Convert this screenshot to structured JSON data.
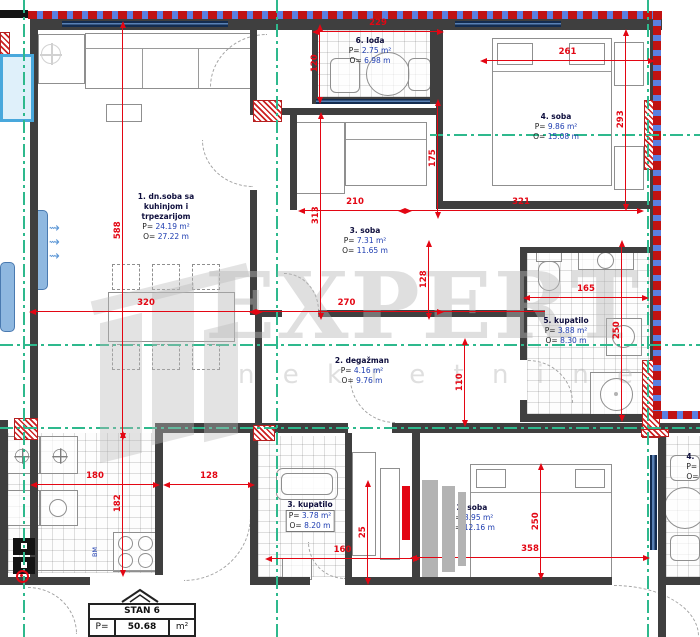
{
  "watermark": {
    "brand": "EXPERT",
    "sub": "n e k r e t n i n e"
  },
  "stamp": {
    "title": "STAN 6",
    "p_label": "P=",
    "p_value": "50.68",
    "p_unit": "m²"
  },
  "labels": {
    "appliance": "BM"
  },
  "rooms": [
    {
      "name": "6. lođa",
      "p_label": "P=",
      "p_value": "2.75",
      "p_unit": "m²",
      "o_label": "O=",
      "o_value": "6.98",
      "o_unit": "m"
    },
    {
      "name": "4. soba",
      "p_label": "P=",
      "p_value": "9.86",
      "p_unit": "m²",
      "o_label": "O=",
      "o_value": "15.08",
      "o_unit": "m"
    },
    {
      "name_line1": "1. dn.soba sa",
      "name_line2": "kuhinjom i",
      "name_line3": "trpezarijom",
      "p_label": "P=",
      "p_value": "24.19",
      "p_unit": "m²",
      "o_label": "O=",
      "o_value": "27.22",
      "o_unit": "m"
    },
    {
      "name": "3. soba",
      "p_label": "P=",
      "p_value": "7.31",
      "p_unit": "m²",
      "o_label": "O=",
      "o_value": "11.65",
      "o_unit": "m"
    },
    {
      "name": "5. kupatilo",
      "p_label": "P=",
      "p_value": "3.88",
      "p_unit": "m²",
      "o_label": "O=",
      "o_value": "8.30",
      "o_unit": "m"
    },
    {
      "name": "2. degažman",
      "p_label": "P=",
      "p_value": "4.16",
      "p_unit": "m²",
      "o_label": "O=",
      "o_value": "9.76",
      "o_unit": "m"
    },
    {
      "name": "3. kupatilo",
      "p_label": "P=",
      "p_value": "3.78",
      "p_unit": "m²",
      "o_label": "O=",
      "o_value": "8.20",
      "o_unit": "m"
    },
    {
      "name": "2. soba",
      "p_label": "P=",
      "p_value": "8.95",
      "p_unit": "m²",
      "o_label": "O=",
      "o_value": "12.16",
      "o_unit": "m"
    },
    {
      "name": "4.",
      "p_label": "P=",
      "p_value": "2",
      "p_unit": "",
      "o_label": "O=",
      "o_value": "6",
      "o_unit": ""
    }
  ],
  "dims": [
    {
      "id": "d229",
      "value": "229"
    },
    {
      "id": "d120",
      "value": "120"
    },
    {
      "id": "d261",
      "value": "261"
    },
    {
      "id": "d293",
      "value": "293"
    },
    {
      "id": "d321",
      "value": "321"
    },
    {
      "id": "d210",
      "value": "210"
    },
    {
      "id": "d175",
      "value": "175"
    },
    {
      "id": "d313",
      "value": "313"
    },
    {
      "id": "d588",
      "value": "588"
    },
    {
      "id": "d320",
      "value": "320"
    },
    {
      "id": "d270",
      "value": "270"
    },
    {
      "id": "d128a",
      "value": "128"
    },
    {
      "id": "d110",
      "value": "110"
    },
    {
      "id": "d165",
      "value": "165"
    },
    {
      "id": "d250a",
      "value": "250"
    },
    {
      "id": "d180",
      "value": "180"
    },
    {
      "id": "d128b",
      "value": "128"
    },
    {
      "id": "d182",
      "value": "182"
    },
    {
      "id": "d160",
      "value": "160"
    },
    {
      "id": "d25",
      "value": "25"
    },
    {
      "id": "d358",
      "value": "358"
    },
    {
      "id": "d250b",
      "value": "250"
    }
  ],
  "colors": {
    "dimension_red": "#e30613",
    "axis_green": "#2eb98d",
    "wall_gray": "#3f3f3f",
    "window_navy": "#17335c",
    "value_blue": "#1d3cb0",
    "hatch_red": "#cc2222",
    "facade_blue": "#5b7fe0",
    "radiator_blue": "#8fb8e0",
    "watermark_gray": "#bababa"
  }
}
